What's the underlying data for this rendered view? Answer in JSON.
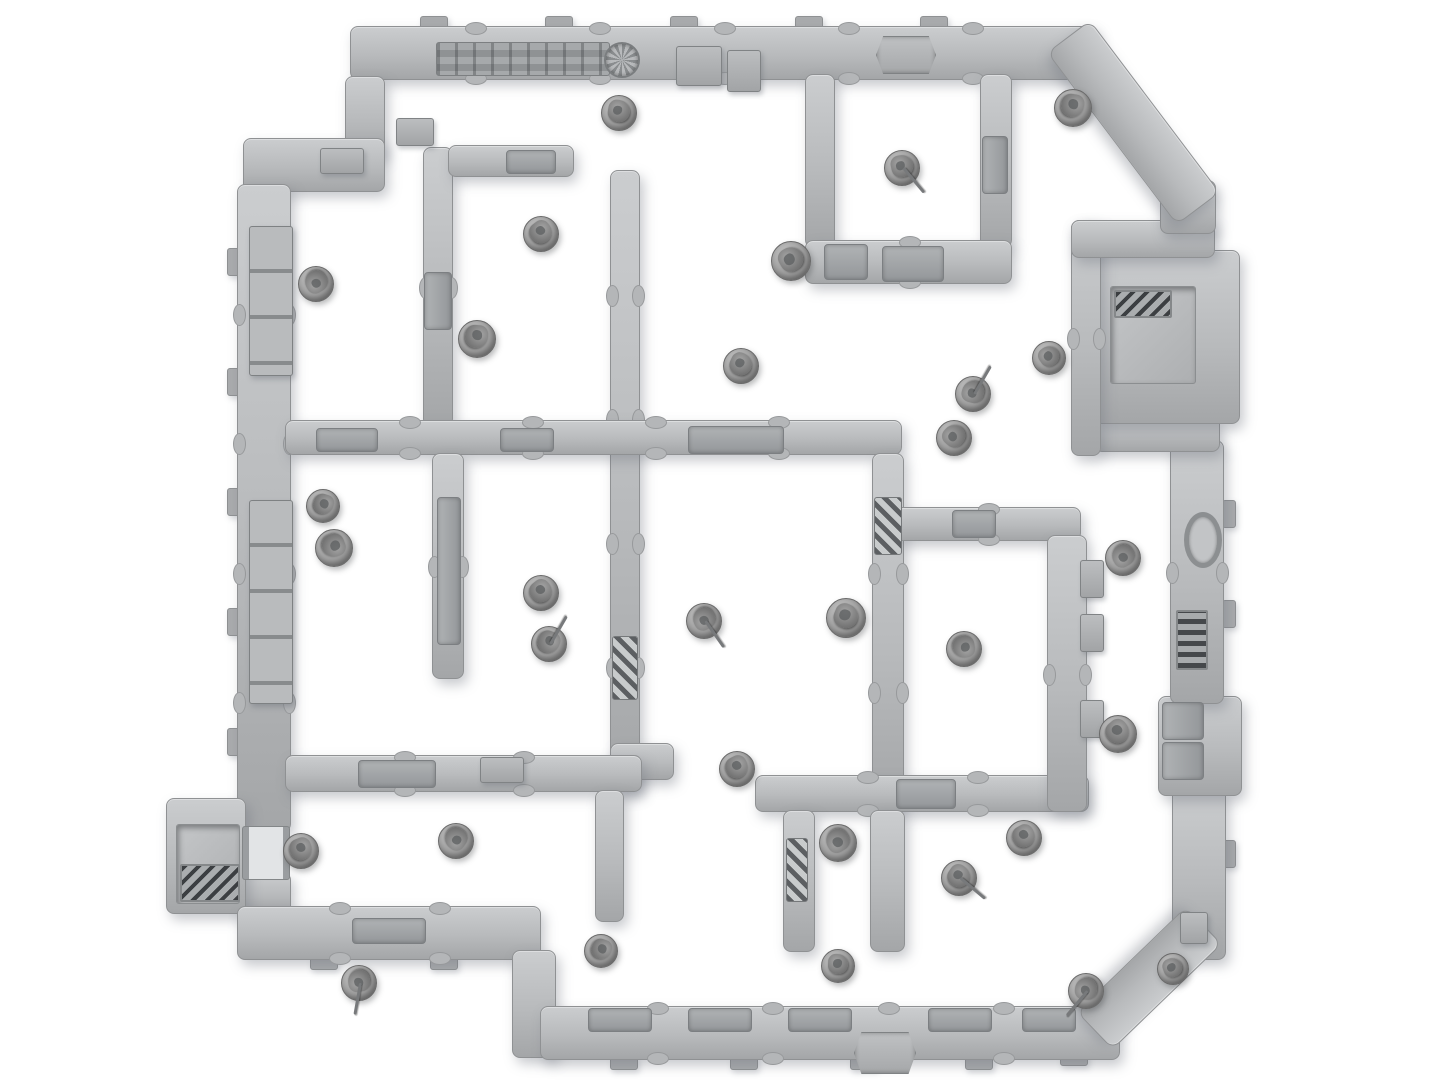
{
  "scene": {
    "width": 1445,
    "height": 1084,
    "description": "top-down render of modular sci-fi terrain board with miniatures",
    "colors": {
      "background": "#ffffff",
      "wall_light": "#cbcdcf",
      "wall_mid": "#b8babc",
      "wall_dark": "#a4a6a8",
      "wall_border": "#8f9193",
      "hazard_dark": "#5c5f62",
      "grille_dark": "#3c3f42",
      "mini_base": "#9d9d9d",
      "mini_figure": "#6f6f6f"
    }
  },
  "walls": [
    {
      "id": "outer-wall-top",
      "x": 350,
      "y": 26,
      "w": 745,
      "h": 52
    },
    {
      "id": "corner-step-vertical",
      "x": 345,
      "y": 76,
      "w": 38,
      "h": 80
    },
    {
      "id": "corner-step-horizontal",
      "x": 243,
      "y": 138,
      "w": 140,
      "h": 52
    },
    {
      "id": "outer-wall-left-upper",
      "x": 237,
      "y": 184,
      "w": 52,
      "h": 646
    },
    {
      "id": "outer-wall-left-lower",
      "x": 237,
      "y": 872,
      "w": 52,
      "h": 40
    },
    {
      "id": "airlock-box-left",
      "x": 166,
      "y": 798,
      "w": 78,
      "h": 114
    },
    {
      "id": "outer-wall-bottom-left",
      "x": 237,
      "y": 906,
      "w": 302,
      "h": 52
    },
    {
      "id": "outer-wall-bottom-step",
      "x": 512,
      "y": 950,
      "w": 42,
      "h": 106
    },
    {
      "id": "outer-wall-bottom",
      "x": 540,
      "y": 1006,
      "w": 578,
      "h": 52
    },
    {
      "id": "outer-wall-right-lower",
      "x": 1172,
      "y": 788,
      "w": 52,
      "h": 170
    },
    {
      "id": "right-wall-bumpout",
      "x": 1158,
      "y": 696,
      "w": 82,
      "h": 98
    },
    {
      "id": "outer-wall-right-mid",
      "x": 1170,
      "y": 440,
      "w": 52,
      "h": 262
    },
    {
      "id": "alcove-jog-bottom",
      "x": 1094,
      "y": 416,
      "w": 124,
      "h": 34
    },
    {
      "id": "alcove-box-right",
      "x": 1094,
      "y": 250,
      "w": 144,
      "h": 172
    },
    {
      "id": "alcove-wall-left",
      "x": 1071,
      "y": 220,
      "w": 28,
      "h": 234
    },
    {
      "id": "alcove-jog-top",
      "x": 1071,
      "y": 220,
      "w": 142,
      "h": 36
    },
    {
      "id": "outer-wall-right-upper",
      "x": 1160,
      "y": 180,
      "w": 54,
      "h": 52
    },
    {
      "id": "room-a-wall-left",
      "x": 805,
      "y": 74,
      "w": 28,
      "h": 172
    },
    {
      "id": "room-a-wall-right",
      "x": 980,
      "y": 74,
      "w": 30,
      "h": 172
    },
    {
      "id": "room-a-wall-bottom",
      "x": 805,
      "y": 240,
      "w": 205,
      "h": 42
    },
    {
      "id": "divider-top-left",
      "x": 423,
      "y": 147,
      "w": 28,
      "h": 278
    },
    {
      "id": "room-tl2-wall-top",
      "x": 448,
      "y": 145,
      "w": 124,
      "h": 30
    },
    {
      "id": "center-wall-vertical",
      "x": 610,
      "y": 170,
      "w": 28,
      "h": 620
    },
    {
      "id": "crossbar-h1",
      "x": 285,
      "y": 420,
      "w": 615,
      "h": 33
    },
    {
      "id": "divider-left-mid",
      "x": 432,
      "y": 453,
      "w": 30,
      "h": 224
    },
    {
      "id": "central-wall-right",
      "x": 872,
      "y": 453,
      "w": 30,
      "h": 357
    },
    {
      "id": "central-wall-bottom",
      "x": 610,
      "y": 743,
      "w": 62,
      "h": 35
    },
    {
      "id": "lower-wall-b1",
      "x": 755,
      "y": 775,
      "w": 332,
      "h": 35
    },
    {
      "id": "pocket-leg-left",
      "x": 783,
      "y": 810,
      "w": 30,
      "h": 140
    },
    {
      "id": "pocket-leg-right",
      "x": 870,
      "y": 810,
      "w": 33,
      "h": 140
    },
    {
      "id": "rc-room-wall-top",
      "x": 895,
      "y": 507,
      "w": 184,
      "h": 32
    },
    {
      "id": "rc-room-wall-right",
      "x": 1047,
      "y": 535,
      "w": 38,
      "h": 275
    },
    {
      "id": "crossbar-h2",
      "x": 285,
      "y": 755,
      "w": 355,
      "h": 35
    },
    {
      "id": "divider-bottom",
      "x": 595,
      "y": 790,
      "w": 27,
      "h": 130
    }
  ],
  "diagonals": [
    {
      "id": "corner-diagonal-top-right",
      "x": 1090,
      "y": 20,
      "len": 214,
      "thick": 52,
      "angle": 53
    },
    {
      "id": "corner-diagonal-bottom-right",
      "x": 1222,
      "y": 944,
      "len": 150,
      "thick": 50,
      "angle": 136
    }
  ],
  "tabs": [
    {
      "x": 420,
      "y": 16,
      "w": 26,
      "h": 12
    },
    {
      "x": 545,
      "y": 16,
      "w": 26,
      "h": 12
    },
    {
      "x": 670,
      "y": 16,
      "w": 26,
      "h": 12
    },
    {
      "x": 795,
      "y": 16,
      "w": 26,
      "h": 12
    },
    {
      "x": 920,
      "y": 16,
      "w": 26,
      "h": 12
    },
    {
      "x": 227,
      "y": 248,
      "w": 12,
      "h": 26
    },
    {
      "x": 227,
      "y": 368,
      "w": 12,
      "h": 26
    },
    {
      "x": 227,
      "y": 488,
      "w": 12,
      "h": 26
    },
    {
      "x": 227,
      "y": 608,
      "w": 12,
      "h": 26
    },
    {
      "x": 227,
      "y": 728,
      "w": 12,
      "h": 26
    },
    {
      "x": 610,
      "y": 1056,
      "w": 26,
      "h": 12
    },
    {
      "x": 730,
      "y": 1056,
      "w": 26,
      "h": 12
    },
    {
      "x": 850,
      "y": 1056,
      "w": 26,
      "h": 12
    },
    {
      "x": 965,
      "y": 1056,
      "w": 26,
      "h": 12
    },
    {
      "x": 1060,
      "y": 1052,
      "w": 26,
      "h": 12
    },
    {
      "x": 310,
      "y": 956,
      "w": 26,
      "h": 12
    },
    {
      "x": 430,
      "y": 956,
      "w": 26,
      "h": 12
    },
    {
      "x": 1222,
      "y": 500,
      "w": 12,
      "h": 26
    },
    {
      "x": 1222,
      "y": 600,
      "w": 12,
      "h": 26
    },
    {
      "x": 1222,
      "y": 840,
      "w": 12,
      "h": 26
    }
  ],
  "features": [
    {
      "type": "panel-strip",
      "name": "pipe-greeble-strip",
      "x": 436,
      "y": 42,
      "w": 172,
      "h": 32
    },
    {
      "type": "fan",
      "name": "fan-vent",
      "x": 604,
      "y": 42,
      "w": 32,
      "h": 32
    },
    {
      "type": "box",
      "name": "console-box",
      "x": 676,
      "y": 46,
      "w": 44,
      "h": 38
    },
    {
      "type": "box",
      "name": "console-box",
      "x": 727,
      "y": 50,
      "w": 32,
      "h": 40
    },
    {
      "type": "emblem",
      "name": "hex-emblem",
      "x": 876,
      "y": 36,
      "w": 58,
      "h": 36
    },
    {
      "type": "panel",
      "name": "hatch-panel",
      "x": 882,
      "y": 246,
      "w": 60,
      "h": 34
    },
    {
      "type": "panel-v",
      "name": "door-panel",
      "x": 982,
      "y": 136,
      "w": 24,
      "h": 56
    },
    {
      "type": "panel",
      "name": "door-panel",
      "x": 824,
      "y": 244,
      "w": 42,
      "h": 34
    },
    {
      "type": "crates",
      "name": "crate-stack",
      "x": 249,
      "y": 226,
      "w": 42,
      "h": 148
    },
    {
      "type": "crates",
      "name": "crate-stack",
      "x": 249,
      "y": 500,
      "w": 42,
      "h": 202
    },
    {
      "type": "panel-v",
      "name": "door-panel",
      "x": 424,
      "y": 272,
      "w": 26,
      "h": 56
    },
    {
      "type": "panel-v",
      "name": "door-panel",
      "x": 437,
      "y": 497,
      "w": 22,
      "h": 146
    },
    {
      "type": "hazard-v",
      "name": "hazard-ladder",
      "x": 612,
      "y": 636,
      "w": 24,
      "h": 62
    },
    {
      "type": "hazard-v",
      "name": "hazard-ladder",
      "x": 874,
      "y": 497,
      "w": 26,
      "h": 56
    },
    {
      "type": "panel",
      "name": "door-panel",
      "x": 316,
      "y": 428,
      "w": 60,
      "h": 22
    },
    {
      "type": "panel",
      "name": "door-panel",
      "x": 500,
      "y": 428,
      "w": 52,
      "h": 22
    },
    {
      "type": "panel",
      "name": "door-lintel",
      "x": 688,
      "y": 426,
      "w": 94,
      "h": 26
    },
    {
      "type": "panel",
      "name": "door-panel",
      "x": 506,
      "y": 150,
      "w": 48,
      "h": 22
    },
    {
      "type": "panel",
      "name": "door-panel",
      "x": 952,
      "y": 510,
      "w": 42,
      "h": 26
    },
    {
      "type": "panel",
      "name": "hatch-panel",
      "x": 358,
      "y": 760,
      "w": 76,
      "h": 26
    },
    {
      "type": "box",
      "name": "console-box",
      "x": 480,
      "y": 757,
      "w": 42,
      "h": 24
    },
    {
      "type": "panel",
      "name": "hatch-panel",
      "x": 896,
      "y": 779,
      "w": 58,
      "h": 28
    },
    {
      "type": "hazard-v",
      "name": "hazard-ladder",
      "x": 786,
      "y": 838,
      "w": 20,
      "h": 62
    },
    {
      "type": "box",
      "name": "wall-box",
      "x": 1080,
      "y": 560,
      "w": 22,
      "h": 36
    },
    {
      "type": "box",
      "name": "wall-box",
      "x": 1080,
      "y": 614,
      "w": 22,
      "h": 36
    },
    {
      "type": "box",
      "name": "wall-box",
      "x": 1080,
      "y": 700,
      "w": 22,
      "h": 36
    },
    {
      "type": "ring",
      "name": "oval-port",
      "x": 1184,
      "y": 512,
      "w": 28,
      "h": 46
    },
    {
      "type": "grille-v",
      "name": "wall-grille",
      "x": 1176,
      "y": 610,
      "w": 28,
      "h": 56
    },
    {
      "type": "panel-v",
      "name": "door-panel",
      "x": 1162,
      "y": 702,
      "w": 40,
      "h": 36
    },
    {
      "type": "panel-v",
      "name": "door-panel",
      "x": 1162,
      "y": 742,
      "w": 40,
      "h": 36
    },
    {
      "type": "box",
      "name": "wall-box",
      "x": 1180,
      "y": 912,
      "w": 26,
      "h": 30
    },
    {
      "type": "recess",
      "name": "alcove-recess",
      "x": 1110,
      "y": 286,
      "w": 84,
      "h": 96
    },
    {
      "type": "grille",
      "name": "alcove-grate",
      "x": 1114,
      "y": 290,
      "w": 54,
      "h": 24
    },
    {
      "type": "recess",
      "name": "airlock-recess",
      "x": 176,
      "y": 824,
      "w": 62,
      "h": 78
    },
    {
      "type": "grille",
      "name": "airlock-grate",
      "x": 180,
      "y": 864,
      "w": 56,
      "h": 34
    },
    {
      "type": "doorframe",
      "name": "airlock-doorway",
      "x": 242,
      "y": 826,
      "w": 46,
      "h": 52
    },
    {
      "type": "emblem",
      "name": "hex-emblem",
      "x": 854,
      "y": 1032,
      "w": 60,
      "h": 40
    },
    {
      "type": "panel",
      "name": "door-lintel",
      "x": 588,
      "y": 1008,
      "w": 62,
      "h": 22
    },
    {
      "type": "panel",
      "name": "door-lintel",
      "x": 688,
      "y": 1008,
      "w": 62,
      "h": 22
    },
    {
      "type": "panel",
      "name": "door-lintel",
      "x": 788,
      "y": 1008,
      "w": 62,
      "h": 22
    },
    {
      "type": "panel",
      "name": "door-lintel",
      "x": 928,
      "y": 1008,
      "w": 62,
      "h": 22
    },
    {
      "type": "panel",
      "name": "door-lintel",
      "x": 1022,
      "y": 1008,
      "w": 52,
      "h": 22
    },
    {
      "type": "panel",
      "name": "hatch-panel",
      "x": 352,
      "y": 918,
      "w": 72,
      "h": 24
    },
    {
      "type": "box",
      "name": "corner-box",
      "x": 320,
      "y": 148,
      "w": 42,
      "h": 24
    },
    {
      "type": "box",
      "name": "corner-box",
      "x": 396,
      "y": 118,
      "w": 36,
      "h": 26
    }
  ],
  "minis": [
    {
      "x": 618,
      "y": 112,
      "r": 17
    },
    {
      "x": 901,
      "y": 167,
      "r": 17,
      "spear": -40
    },
    {
      "x": 1072,
      "y": 107,
      "r": 18
    },
    {
      "x": 790,
      "y": 260,
      "r": 19
    },
    {
      "x": 1048,
      "y": 357,
      "r": 16
    },
    {
      "x": 972,
      "y": 393,
      "r": 17,
      "spear": 210
    },
    {
      "x": 953,
      "y": 437,
      "r": 17
    },
    {
      "x": 740,
      "y": 365,
      "r": 17
    },
    {
      "x": 315,
      "y": 283,
      "r": 17
    },
    {
      "x": 540,
      "y": 233,
      "r": 17
    },
    {
      "x": 476,
      "y": 338,
      "r": 18
    },
    {
      "x": 322,
      "y": 505,
      "r": 16
    },
    {
      "x": 333,
      "y": 547,
      "r": 18
    },
    {
      "x": 540,
      "y": 592,
      "r": 17
    },
    {
      "x": 548,
      "y": 643,
      "r": 17,
      "spear": 210
    },
    {
      "x": 703,
      "y": 620,
      "r": 17,
      "spear": -35
    },
    {
      "x": 845,
      "y": 617,
      "r": 19
    },
    {
      "x": 736,
      "y": 768,
      "r": 17
    },
    {
      "x": 963,
      "y": 648,
      "r": 17
    },
    {
      "x": 1122,
      "y": 557,
      "r": 17
    },
    {
      "x": 1117,
      "y": 733,
      "r": 18
    },
    {
      "x": 300,
      "y": 850,
      "r": 17
    },
    {
      "x": 455,
      "y": 840,
      "r": 17
    },
    {
      "x": 358,
      "y": 982,
      "r": 17,
      "spear": 10
    },
    {
      "x": 600,
      "y": 950,
      "r": 16
    },
    {
      "x": 837,
      "y": 842,
      "r": 18
    },
    {
      "x": 837,
      "y": 965,
      "r": 16
    },
    {
      "x": 958,
      "y": 877,
      "r": 17,
      "spear": -50
    },
    {
      "x": 1023,
      "y": 837,
      "r": 17
    },
    {
      "x": 1085,
      "y": 990,
      "r": 17,
      "spear": 40
    },
    {
      "x": 1172,
      "y": 968,
      "r": 15
    }
  ]
}
